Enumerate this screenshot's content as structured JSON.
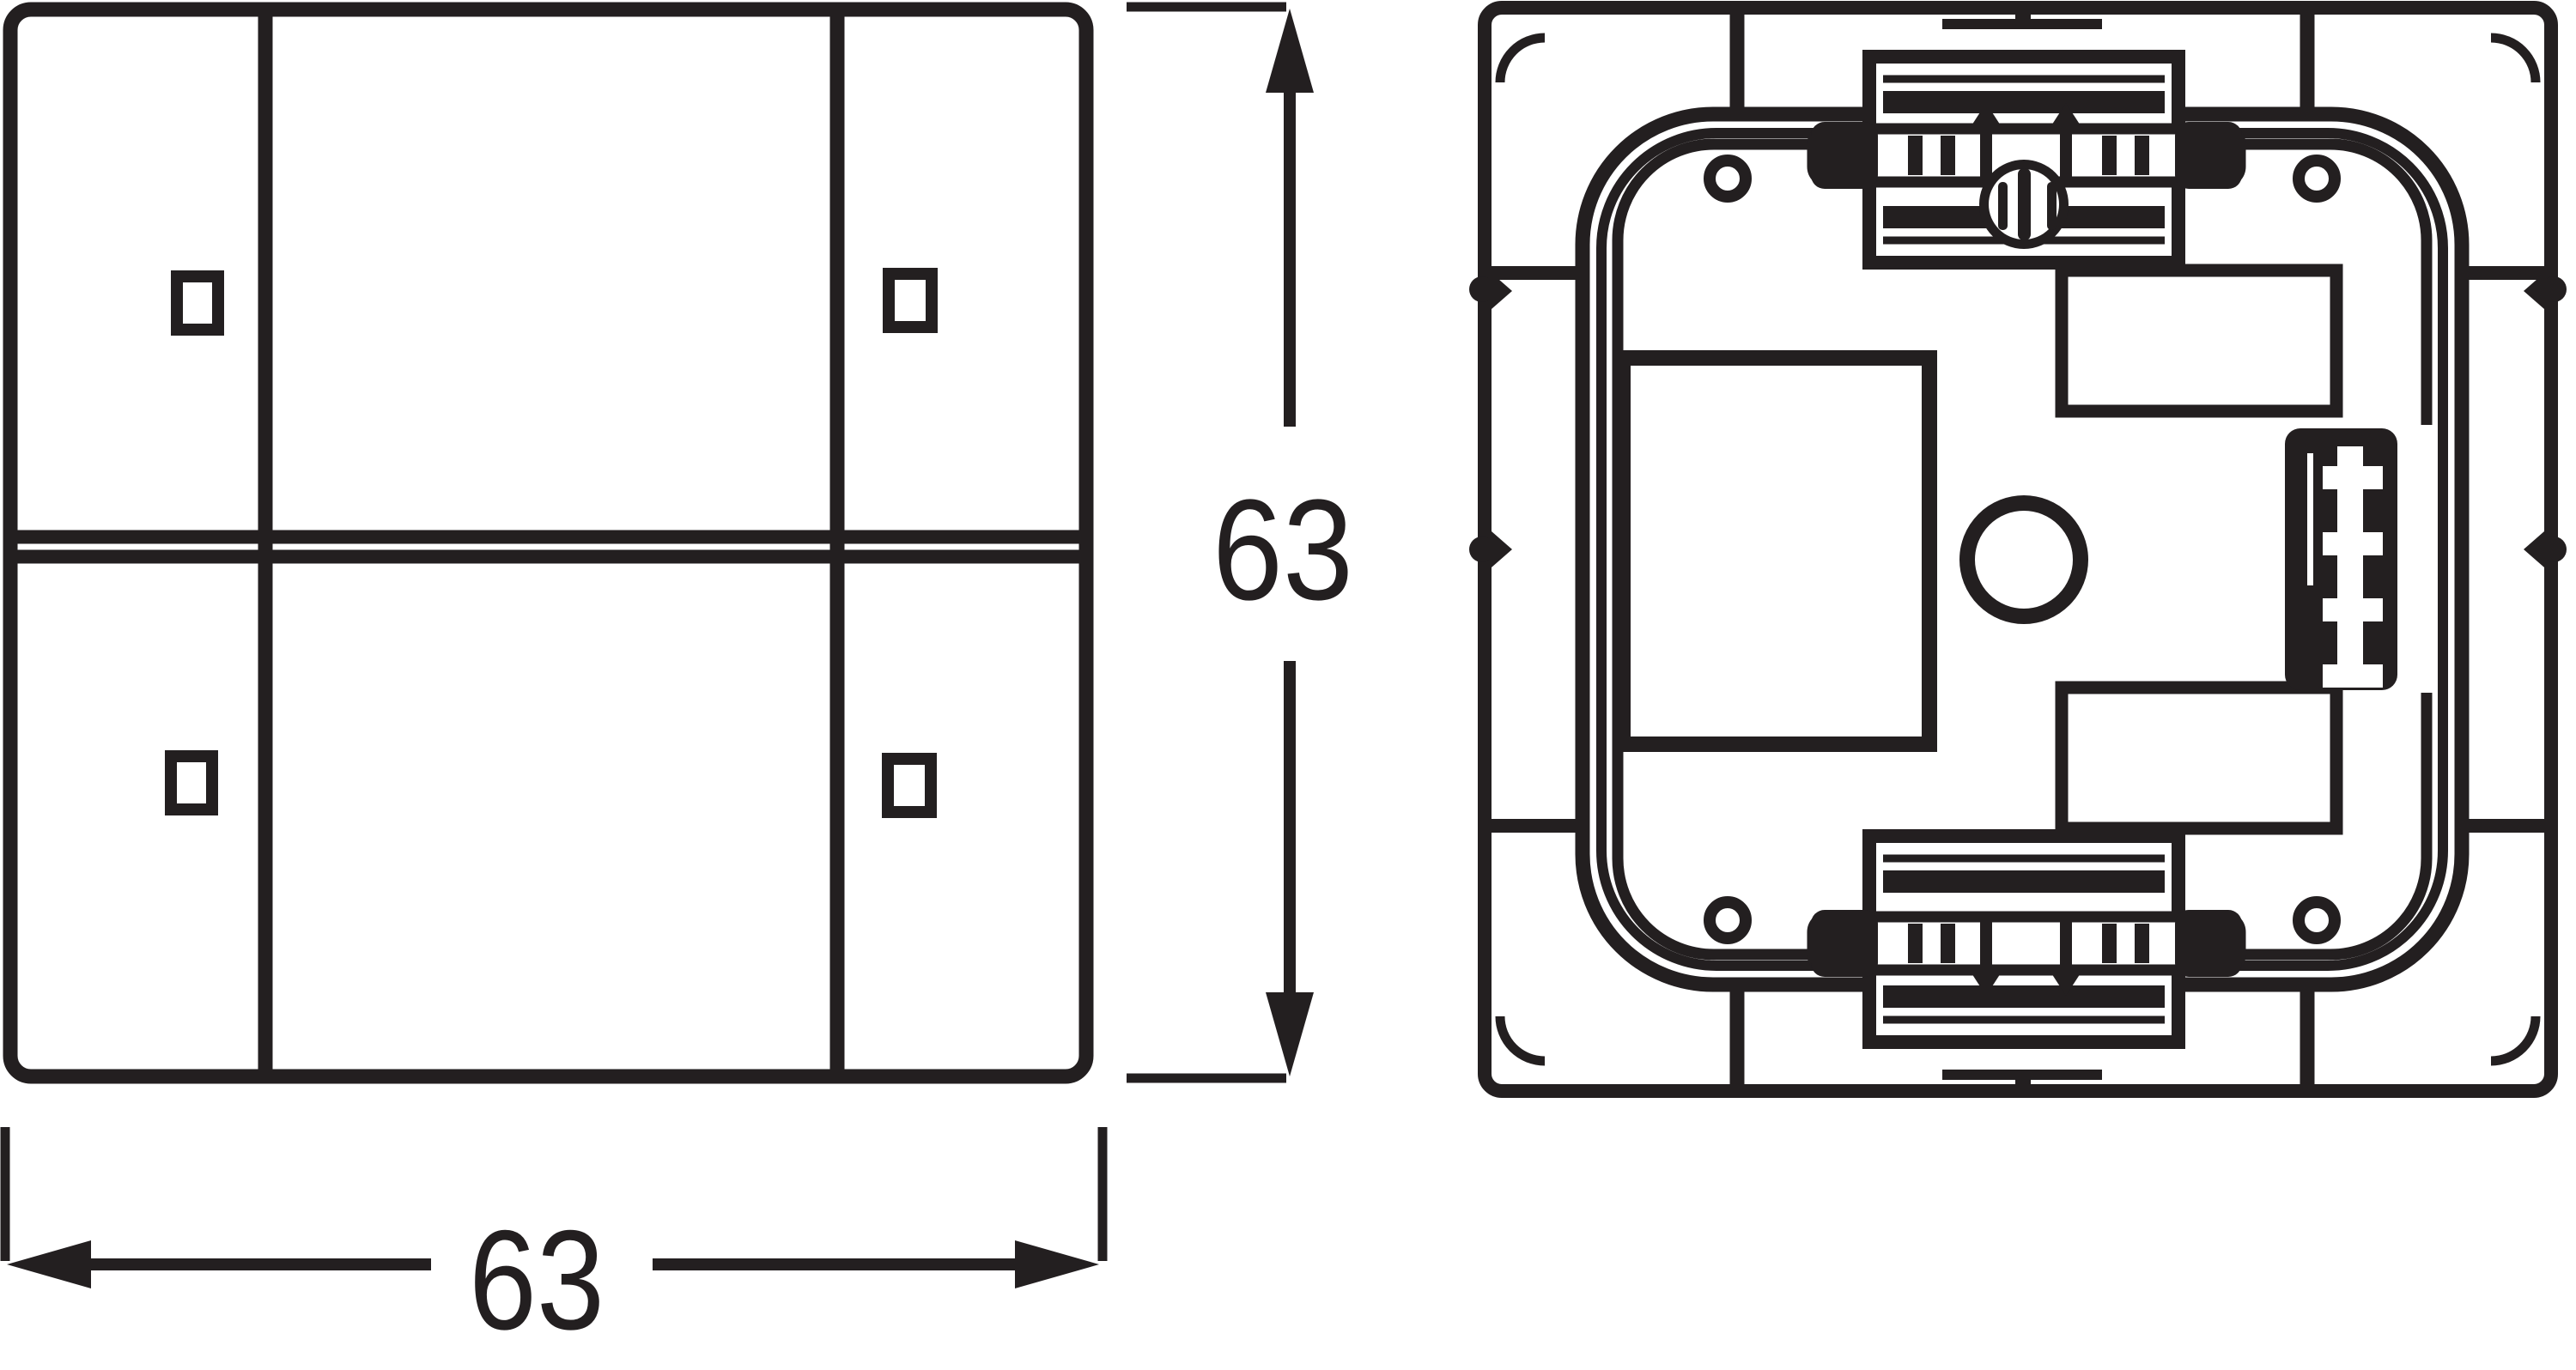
{
  "drawing": {
    "type": "technical-dimension-drawing",
    "views": 2,
    "width_dimension": {
      "value": "63"
    },
    "height_dimension": {
      "value": "63"
    },
    "colors": {
      "line": "#231f20",
      "background": "#ffffff"
    }
  }
}
